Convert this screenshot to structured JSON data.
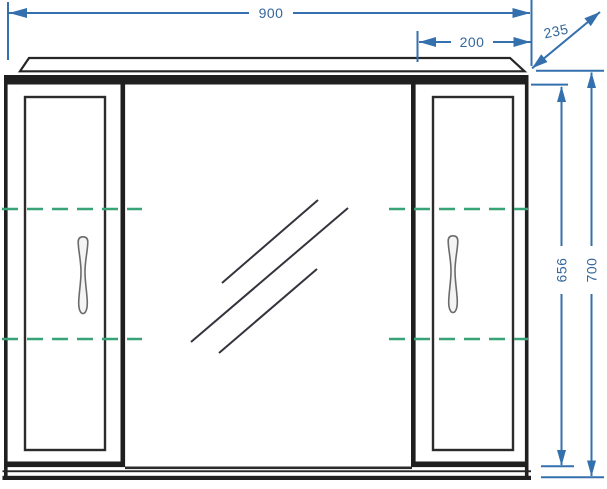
{
  "drawing": {
    "subject": "mirrored-cabinet-front-elevation",
    "dimension_labels": {
      "overall_width": "900",
      "side_cabinet_width": "200",
      "depth": "235",
      "carcass_height": "656",
      "overall_height": "700"
    },
    "colors": {
      "dimension_lines": "#3470ae",
      "shelf_dashed_lines": "#37a377",
      "outline": "#222222",
      "background": "#ffffff"
    }
  }
}
